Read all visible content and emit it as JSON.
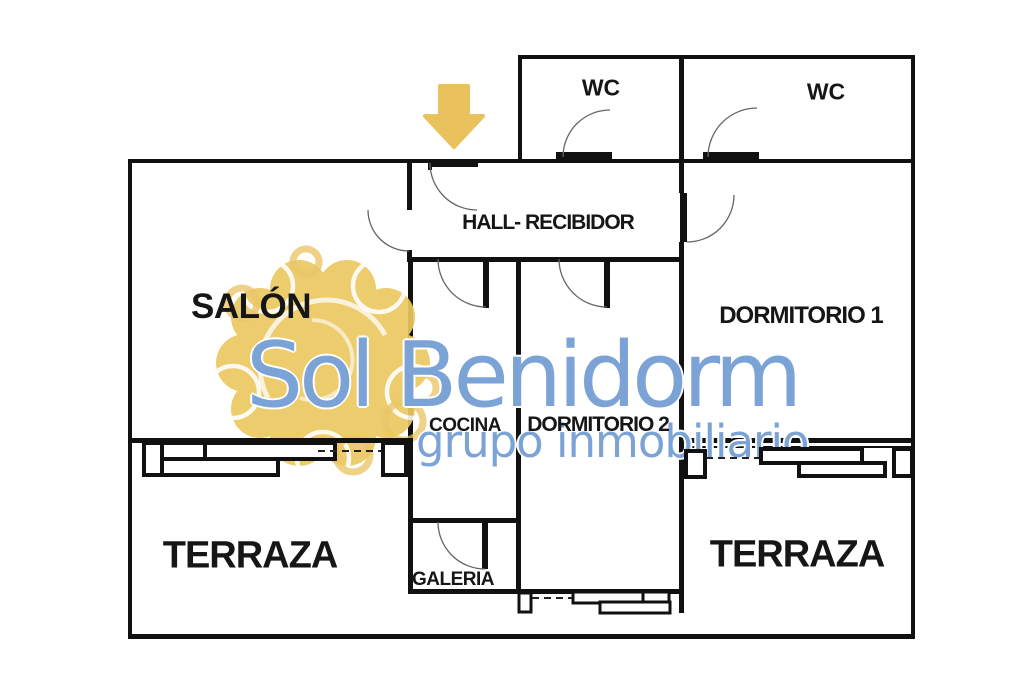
{
  "plan": {
    "type": "apartment-floor-plan",
    "rooms": [
      {
        "key": "wc-left",
        "label": "WC"
      },
      {
        "key": "wc-right",
        "label": "WC"
      },
      {
        "key": "hall",
        "label": "HALL- RECIBIDOR"
      },
      {
        "key": "salon",
        "label": "SALÓN"
      },
      {
        "key": "dormitorio-1",
        "label": "DORMITORIO 1"
      },
      {
        "key": "cocina",
        "label": "COCINA"
      },
      {
        "key": "dormitorio-2",
        "label": "DORMITORIO 2"
      },
      {
        "key": "terraza-left",
        "label": "TERRAZA"
      },
      {
        "key": "galeria",
        "label": "GALERIA"
      },
      {
        "key": "terraza-right",
        "label": "TERRAZA"
      }
    ]
  },
  "watermark": {
    "brand": "Sol Benidorm",
    "tagline": "grupo inmobiliario",
    "text_color": "#7ba3d6",
    "sun_color": "#ecc862"
  },
  "icons": {
    "entrance_arrow": "down-arrow-icon",
    "arrow_color": "#e9c25d"
  },
  "colors": {
    "wall": "#111111",
    "label": "#161616",
    "background": "#ffffff"
  }
}
